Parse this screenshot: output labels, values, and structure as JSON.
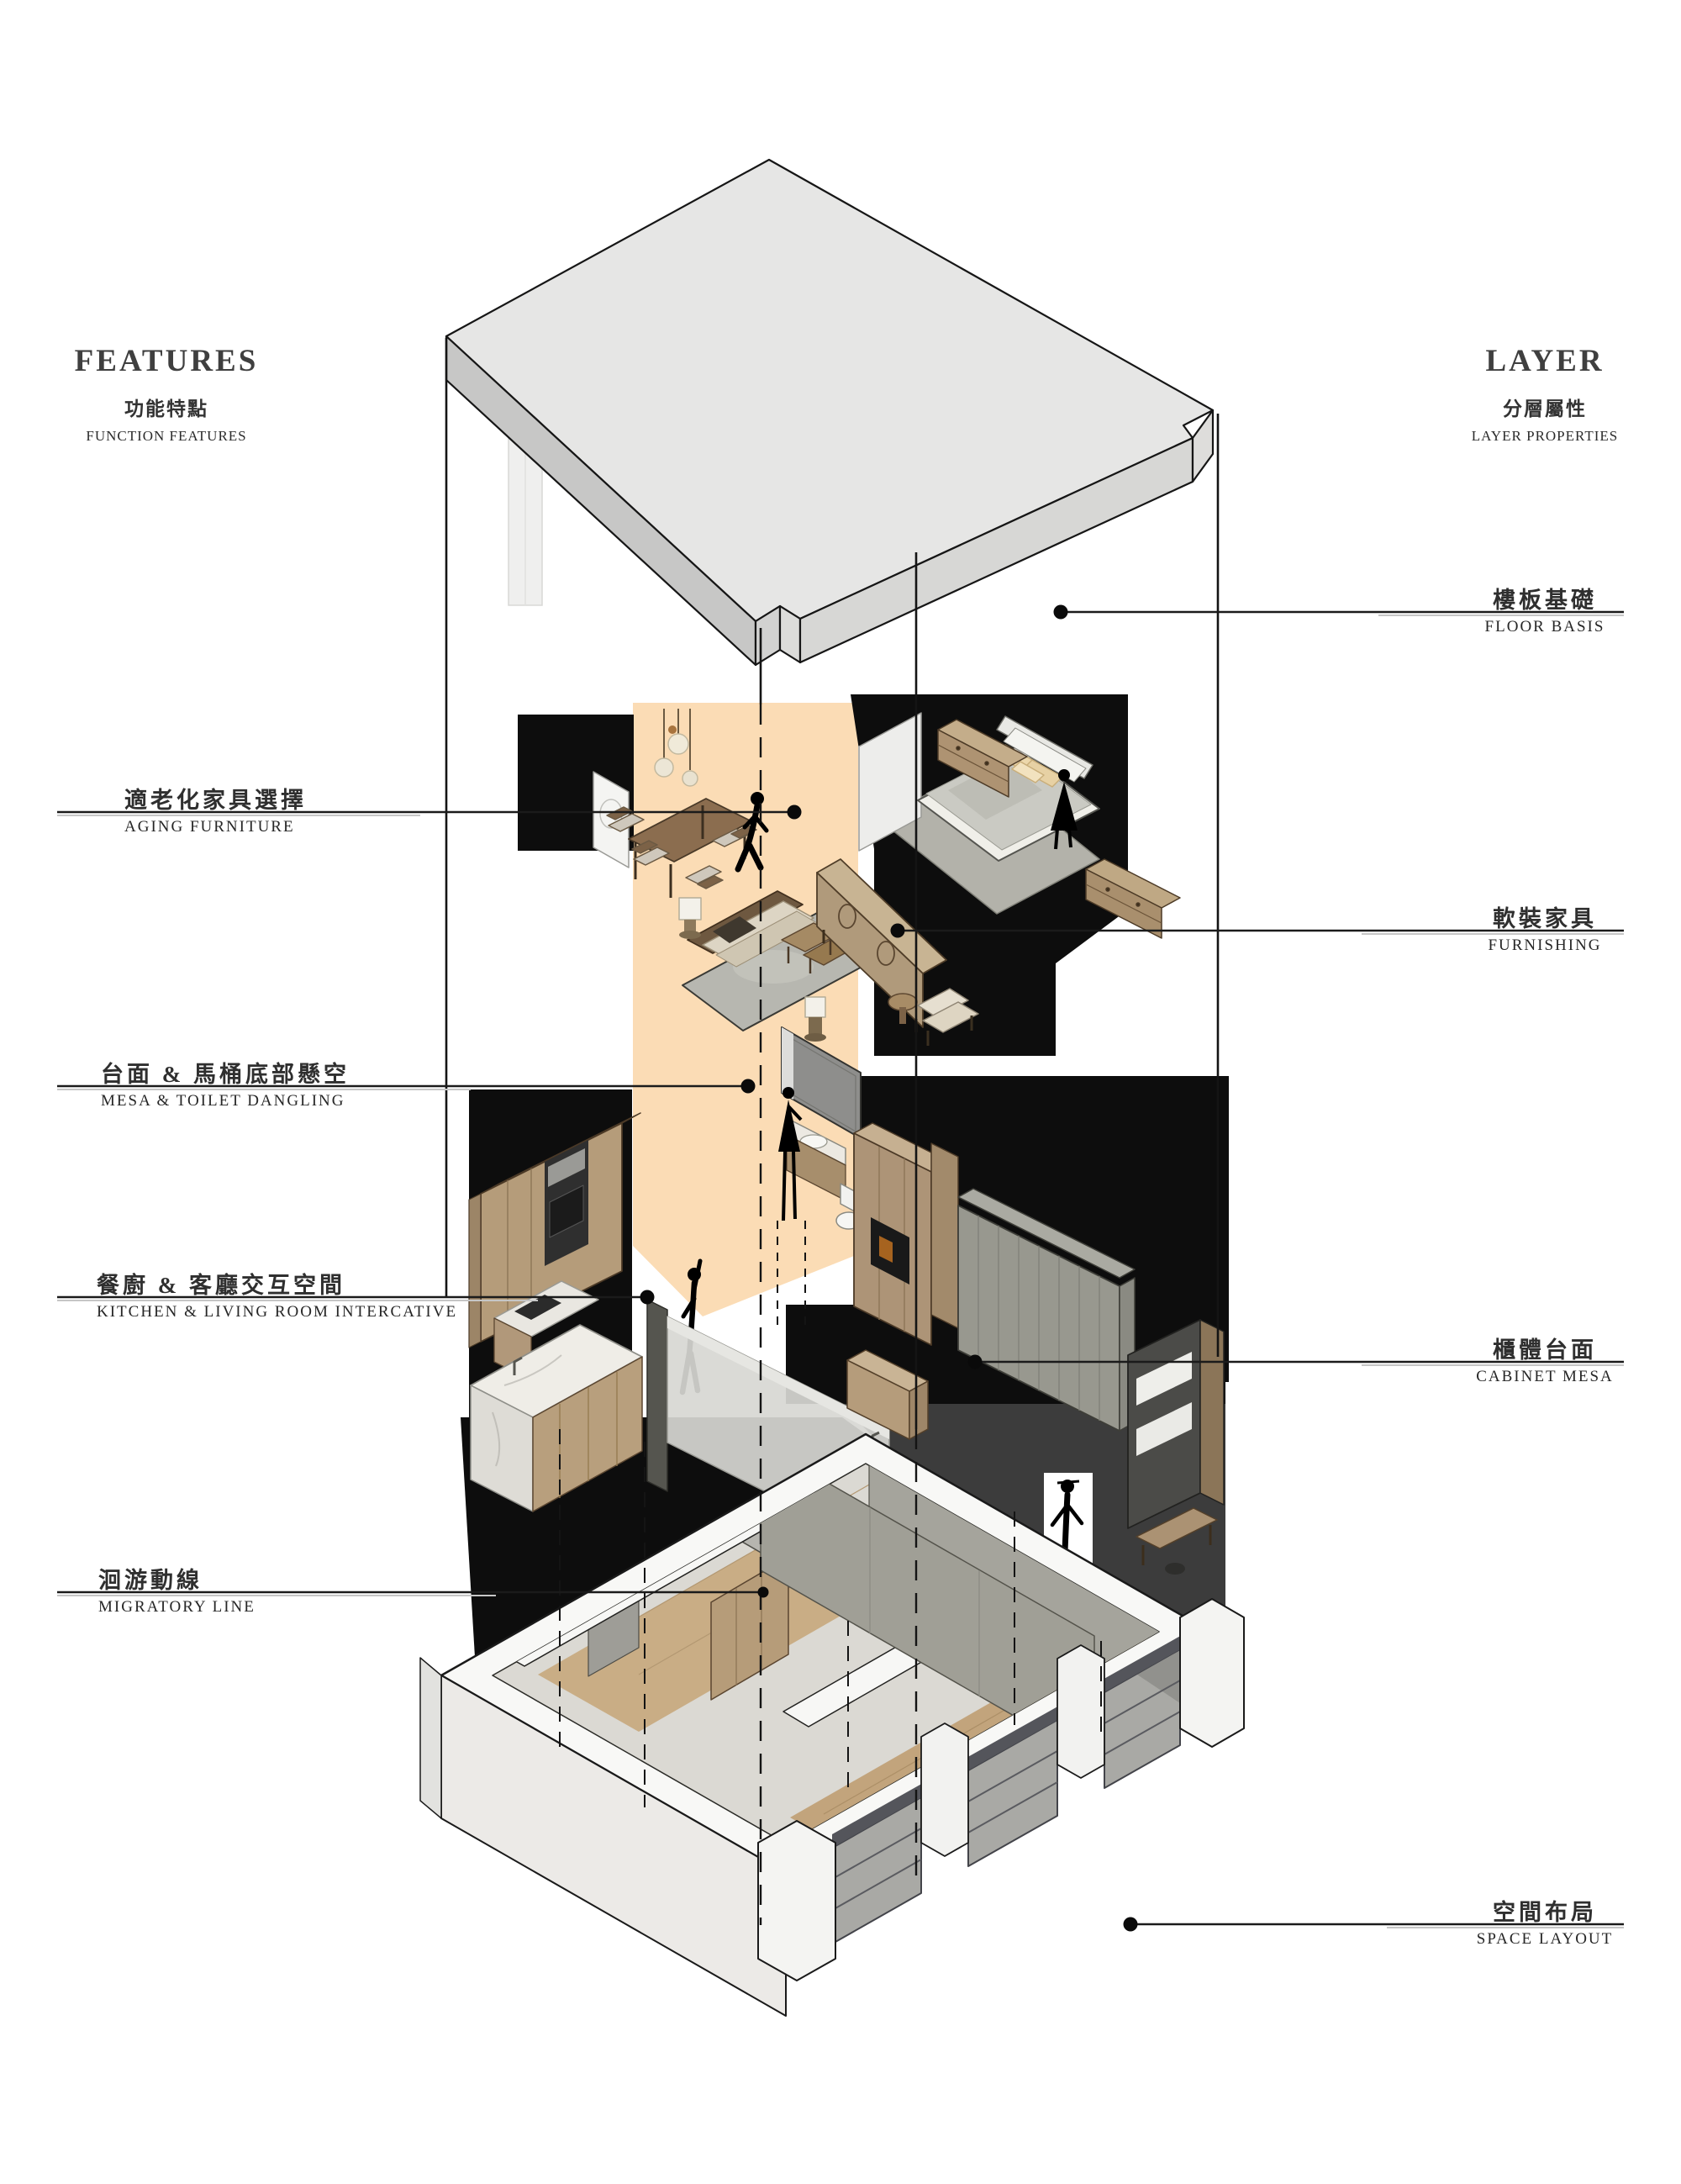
{
  "page": {
    "background": "#ffffff"
  },
  "left_column": {
    "title": "FEATURES",
    "subtitle_zh": "功能特點",
    "subtitle_en": "FUNCTION FEATURES"
  },
  "right_column": {
    "title": "LAYER",
    "subtitle_zh": "分層屬性",
    "subtitle_en": "LAYER PROPERTIES"
  },
  "feature_callouts": [
    {
      "zh": "適老化家具選擇",
      "en": "AGING FURNITURE"
    },
    {
      "zh": "台面 & 馬桶底部懸空",
      "en": "MESA & TOILET DANGLING"
    },
    {
      "zh": "餐廚 & 客廳交互空間",
      "en": "KITCHEN & LIVING ROOM INTERCATIVE"
    },
    {
      "zh": "洄游動線",
      "en": "MIGRATORY LINE"
    }
  ],
  "layer_callouts": [
    {
      "zh": "樓板基礎",
      "en": "FLOOR BASIS"
    },
    {
      "zh": "軟裝家具",
      "en": "FURNISHING"
    },
    {
      "zh": "櫃體台面",
      "en": "CABINET MESA"
    },
    {
      "zh": "空間布局",
      "en": "SPACE LAYOUT"
    }
  ],
  "colors": {
    "highlight_band": "#fbdcb5",
    "slab_top": "#e6e6e5",
    "wood": "#b59c7b",
    "marble": "#edebe5",
    "wall_gray": "#a0a098",
    "glass": "#9c9c97",
    "shadow_black": "#0d0d0d",
    "shadow_gray": "#3c3c3c",
    "text": "#2e2e2e"
  }
}
